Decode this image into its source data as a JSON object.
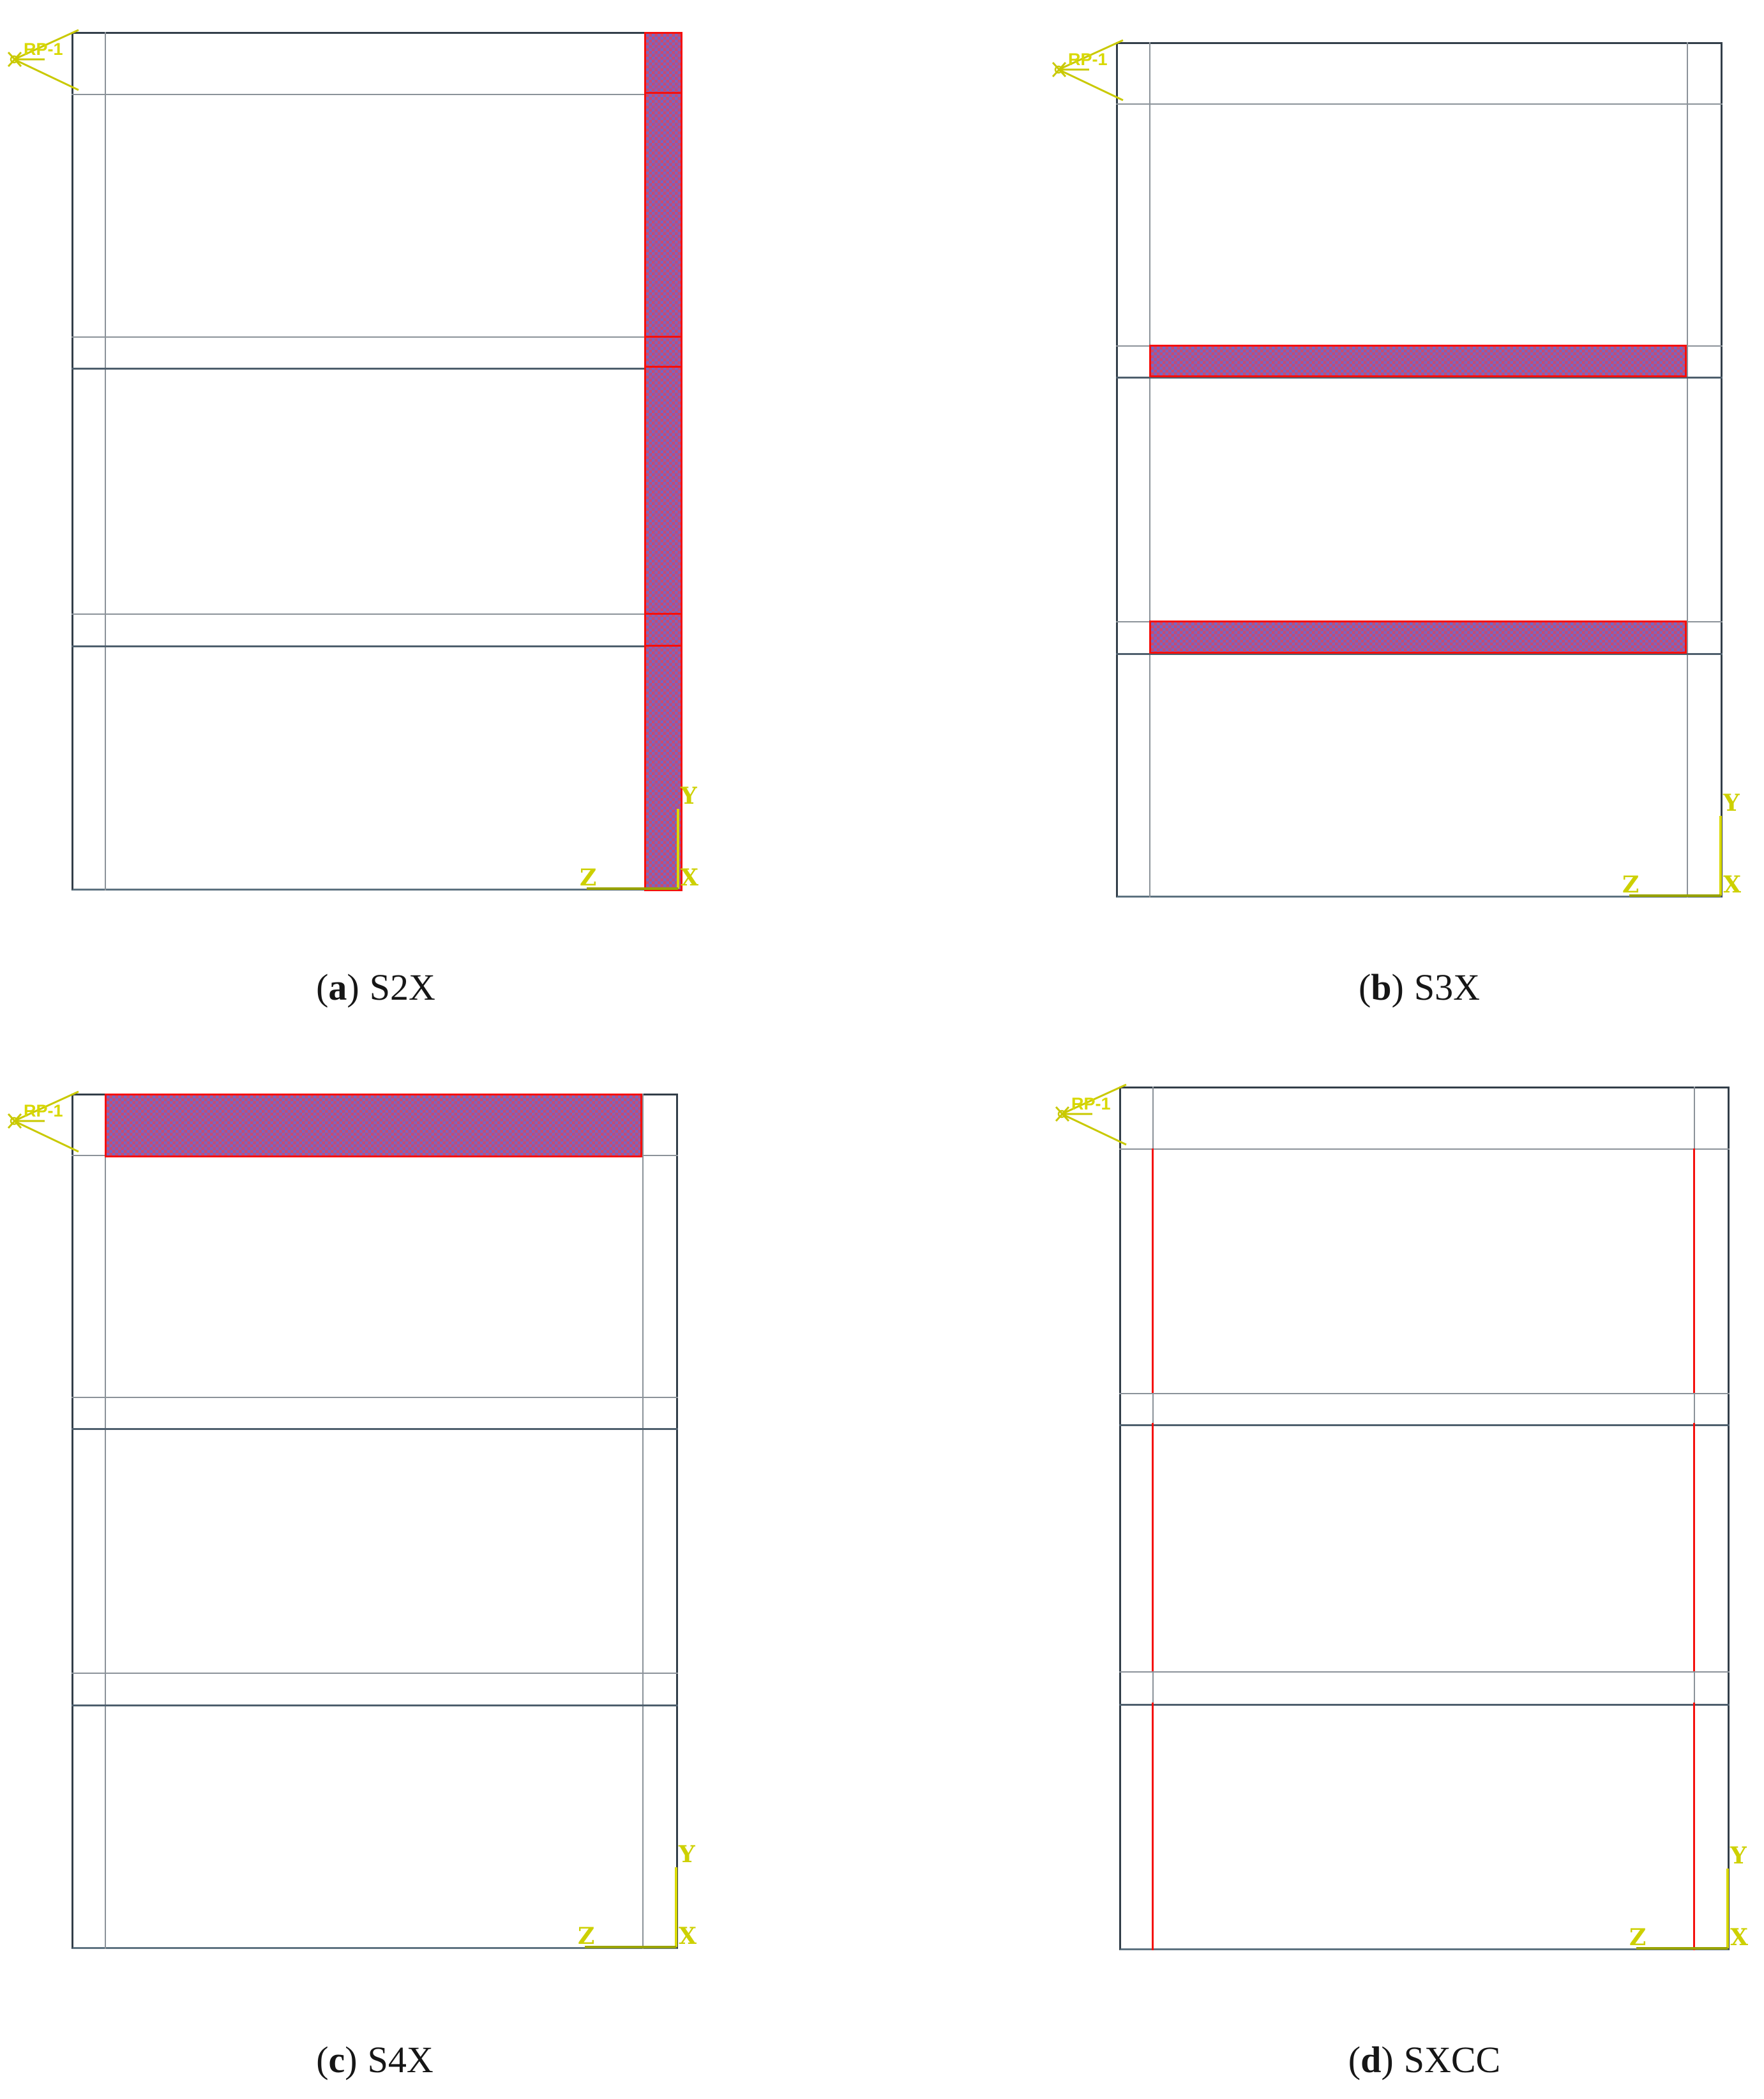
{
  "figure": {
    "panels": [
      {
        "key": "a",
        "caption": {
          "open": "(",
          "letter": "a",
          "close": ")",
          "name": "S2X"
        },
        "reference_point_label": "RP-1",
        "axis_labels": {
          "y": "Y",
          "z": "Z",
          "x": "X"
        },
        "highlighted_member": "right column (full height, hatched purple with red outline)"
      },
      {
        "key": "b",
        "caption": {
          "open": "(",
          "letter": "b",
          "close": ")",
          "name": "S3X"
        },
        "reference_point_label": "RP-1",
        "axis_labels": {
          "y": "Y",
          "z": "Z",
          "x": "X"
        },
        "highlighted_member": "two intermediate floor beams (hatched purple with red outline)"
      },
      {
        "key": "c",
        "caption": {
          "open": "(",
          "letter": "c",
          "close": ")",
          "name": "S4X"
        },
        "reference_point_label": "RP-1",
        "axis_labels": {
          "y": "Y",
          "z": "Z",
          "x": "X"
        },
        "highlighted_member": "roof beam (hatched purple with red outline)"
      },
      {
        "key": "d",
        "caption": {
          "open": "(",
          "letter": "d",
          "close": ")",
          "name": "SXCC"
        },
        "reference_point_label": "RP-1",
        "axis_labels": {
          "y": "Y",
          "z": "Z",
          "x": "X"
        },
        "highlighted_member": "inner column edge lines in every story (red lines)"
      }
    ]
  },
  "colors": {
    "highlight_red": "#f50f0c",
    "checker_pink": "#c84a70",
    "checker_violet": "#7866c2",
    "marker_yellow": "#c9c900",
    "axis_label_yellow": "#cdd000",
    "line_dark": "#323e49",
    "line_gray": "#8b9299",
    "line_steel": "#4e5f6d",
    "background": "#ffffff"
  }
}
